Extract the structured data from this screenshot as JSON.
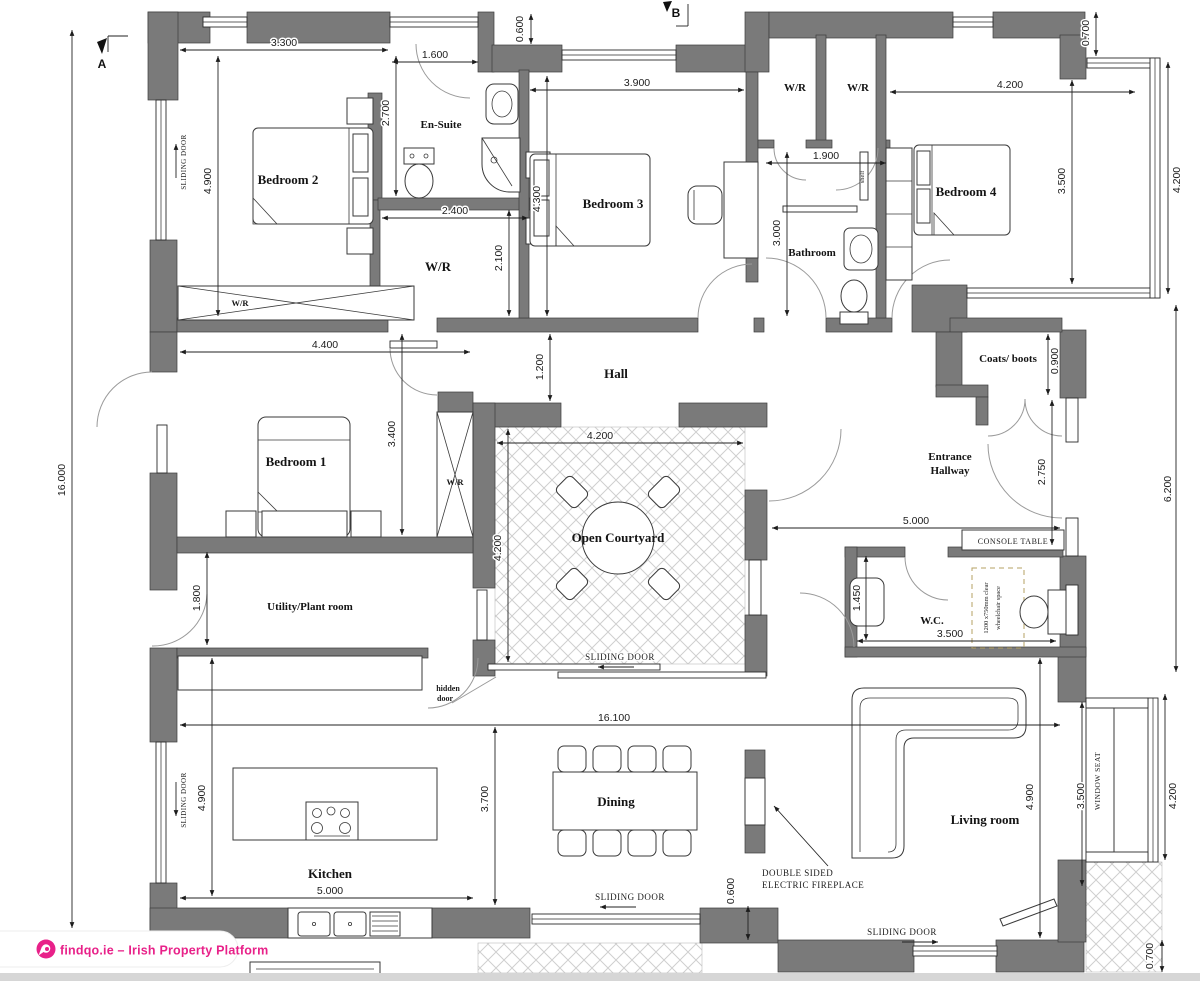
{
  "page": {
    "badge": {
      "logo_icon": "findqo-logo-icon",
      "text": "findqo.ie – Irish Property Platform",
      "pink": "#e82189"
    },
    "footer_strip_color": "#d6d6d6",
    "background": "#ffffff"
  },
  "plan": {
    "colors": {
      "wall": "#7a7a7a",
      "line": "#2b2b2b",
      "door_arc": "#9a9a9a",
      "courtyard_hatch": "#cfcfcf",
      "wheelchair_dash": "#b5a163"
    },
    "rooms": {
      "bedroom1": "Bedroom 1",
      "bedroom2": "Bedroom 2",
      "bedroom3": "Bedroom 3",
      "bedroom4": "Bedroom 4",
      "ensuite": "En-Suite",
      "bathroom": "Bathroom",
      "hall": "Hall",
      "open_courtyard": "Open Courtyard",
      "entrance_line1": "Entrance",
      "entrance_line2": "Hallway",
      "coats_boots": "Coats/ boots",
      "wc": "W.C.",
      "utility": "Utility/Plant room",
      "kitchen": "Kitchen",
      "dining": "Dining",
      "living": "Living room",
      "wr": "W/R"
    },
    "dims": {
      "d16000": "16.000",
      "d16100": "16.100",
      "d3300": "3.300",
      "d1600": "1.600",
      "d0600": "0.600",
      "d0700": "0.700",
      "d2700": "2.700",
      "d4900": "4.900",
      "d3900": "3.900",
      "d4300": "4.300",
      "d2400": "2.400",
      "d2100": "2.100",
      "d1900": "1.900",
      "d3000": "3.000",
      "d4200": "4.200",
      "d3500": "3.500",
      "d4400": "4.400",
      "d3400": "3.400",
      "d1200": "1.200",
      "d0900": "0.900",
      "d2750": "2.750",
      "d6200": "6.200",
      "d5000": "5.000",
      "d1450": "1.450",
      "d1800": "1.800",
      "d3700": "3.700"
    },
    "annotations": {
      "sliding_door": "SLIDING DOOR",
      "hidden_door_line1": "hidden",
      "hidden_door_line2": "door",
      "console_table": "CONSOLE TABLE",
      "window_seat": "WINDOW SEAT",
      "fireplace_line1": "DOUBLE SIDED",
      "fireplace_line2": "ELECTRIC FIREPLACE",
      "wheelchair_line1": "1200 x750mm clear",
      "wheelchair_line2": "wheelchair space",
      "shelf": "shelf",
      "section_a": "A",
      "section_b": "B"
    }
  }
}
